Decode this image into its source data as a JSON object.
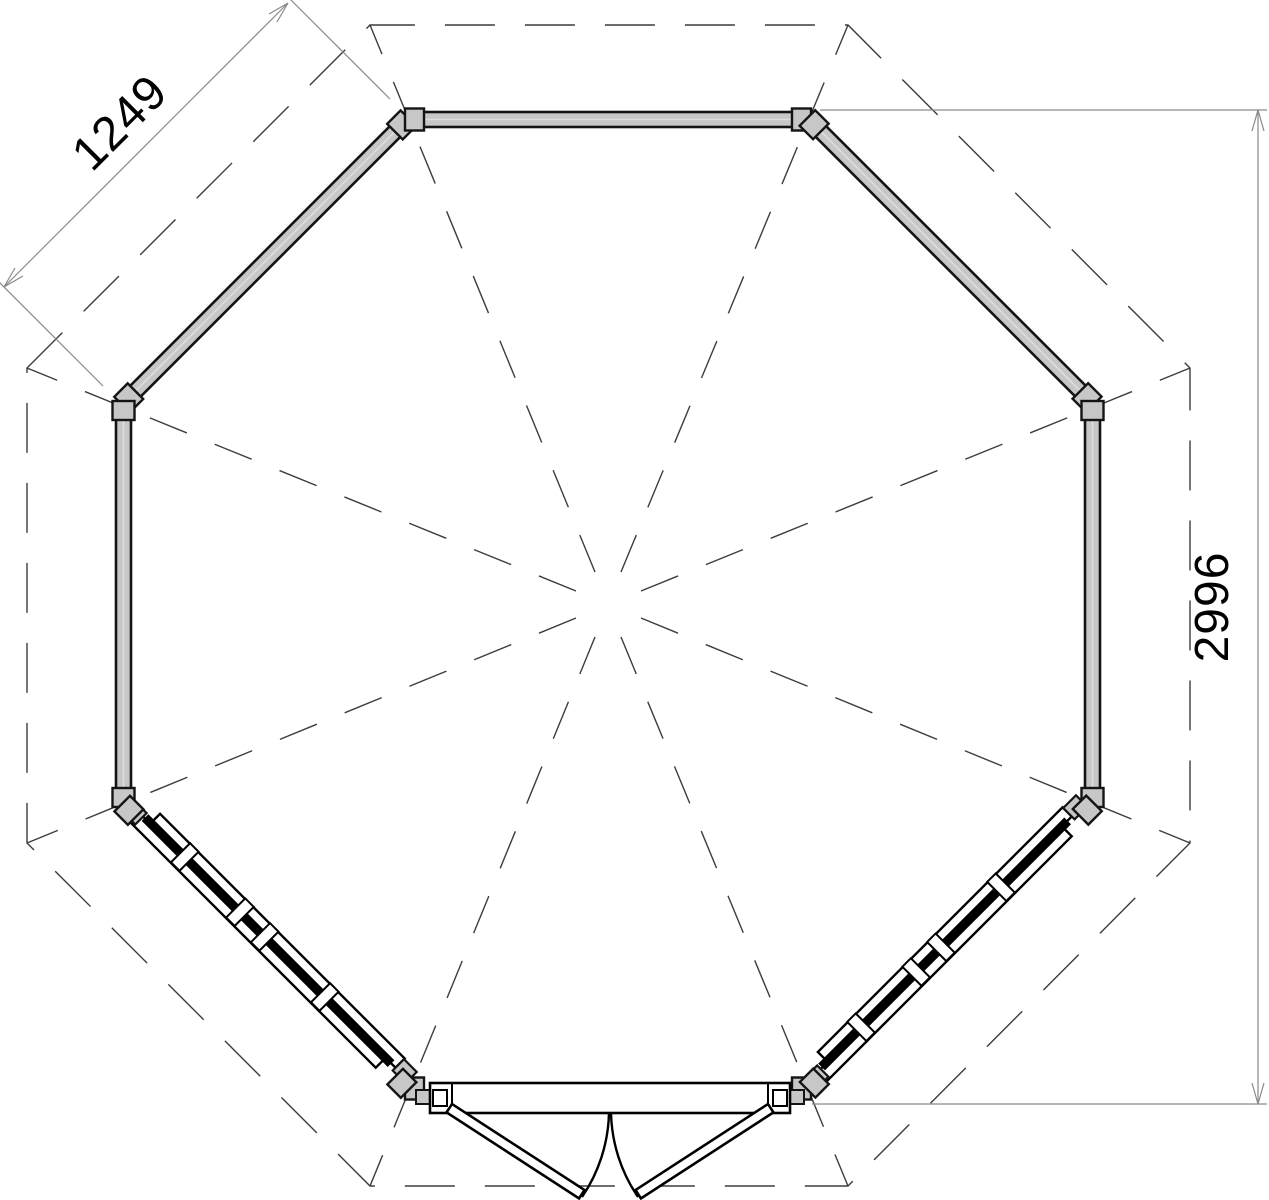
{
  "drawing": {
    "type": "octagonal gazebo floor plan",
    "dimensions": {
      "side_mm": "1249",
      "height_mm": "2996"
    },
    "colors": {
      "background": "#ffffff",
      "wall_fill": "#c7c7c7",
      "outline": "#141414",
      "glazing": "#000000",
      "dashed_line": "#3c3c3c",
      "dimension_line": "#8a8a8a",
      "dimension_text": "#000000"
    }
  }
}
